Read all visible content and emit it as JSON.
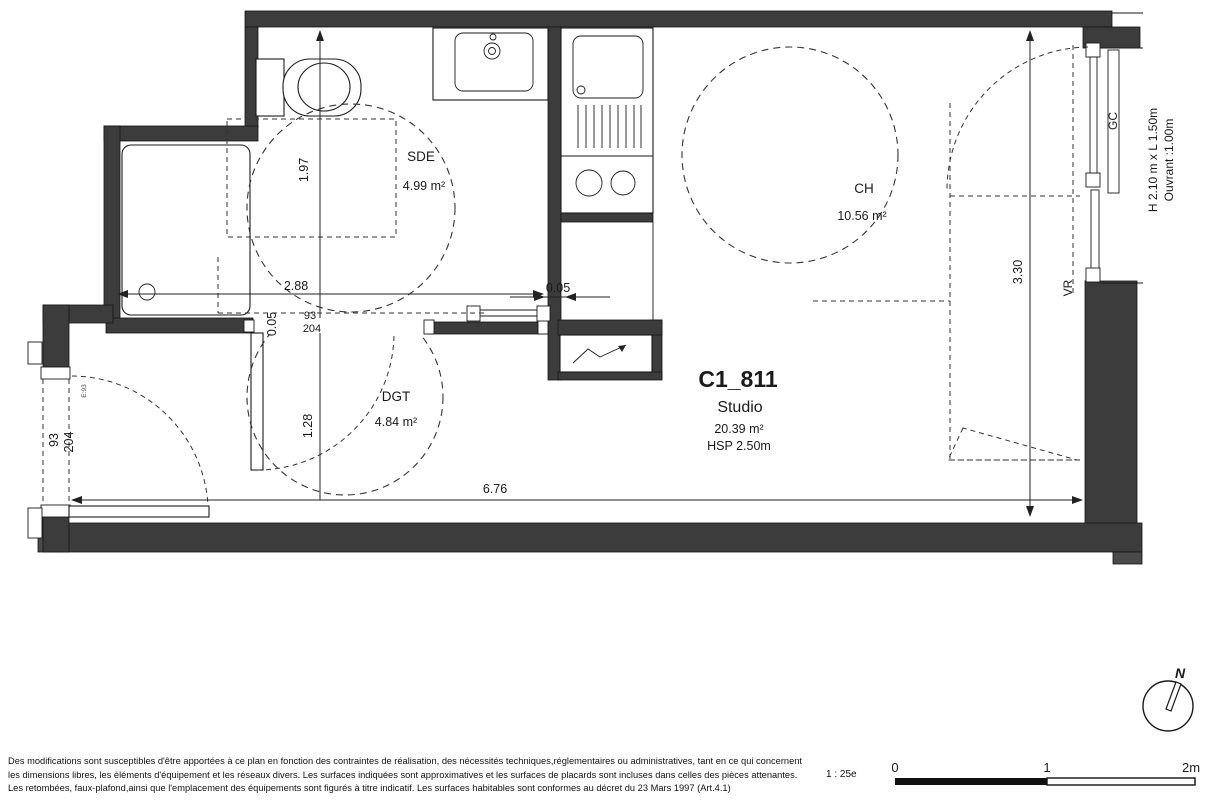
{
  "unit": {
    "id": "C1_811",
    "type": "Studio",
    "area": "20.39 m²",
    "hsp": "HSP 2.50m"
  },
  "rooms": {
    "sde": {
      "name": "SDE",
      "area": "4.99 m²"
    },
    "ch": {
      "name": "CH",
      "area": "10.56 m²"
    },
    "dgt": {
      "name": "DGT",
      "area": "4.84 m²"
    }
  },
  "dims": {
    "sde_height": "1.97",
    "sde_width": "2.88",
    "gap_h": "0.05",
    "gap_v": "0.05",
    "dgt_height": "1.28",
    "total_width": "6.76",
    "ch_height": "3.30",
    "entry_door_w": "93",
    "entry_door_h": "204",
    "sde_door_w": "93",
    "sde_door_h": "204",
    "entry_door_tag": "E:93"
  },
  "window": {
    "size": "H 2.10 m x  L 1.50m",
    "ouvrant": "Ouvrant :1.00m",
    "gc": "GC",
    "vr": "VR"
  },
  "compass": {
    "north": "N"
  },
  "scalebar": {
    "ratio": "1 : 25e",
    "t0": "0",
    "t1": "1",
    "t2": "2m"
  },
  "disclaimer": {
    "line1": "Des modifications sont susceptibles d'être apportées à ce plan en fonction des contraintes de réalisation, des nécessités techniques,réglementaires ou administratives, tant en ce qui concernent",
    "line2": "les dimensions libres, les éléments d'équipement et les réseaux divers. Les surfaces indiquées sont approximatives et les surfaces de placards sont incluses dans celles des pièces attenantes.",
    "line3": "Les retombées, faux-plafond,ainsi que l'emplacement des équipements sont figurés à titre indicatif. Les surfaces habitables sont conformes au décret du 23 Mars 1997 (Art.4.1)"
  }
}
